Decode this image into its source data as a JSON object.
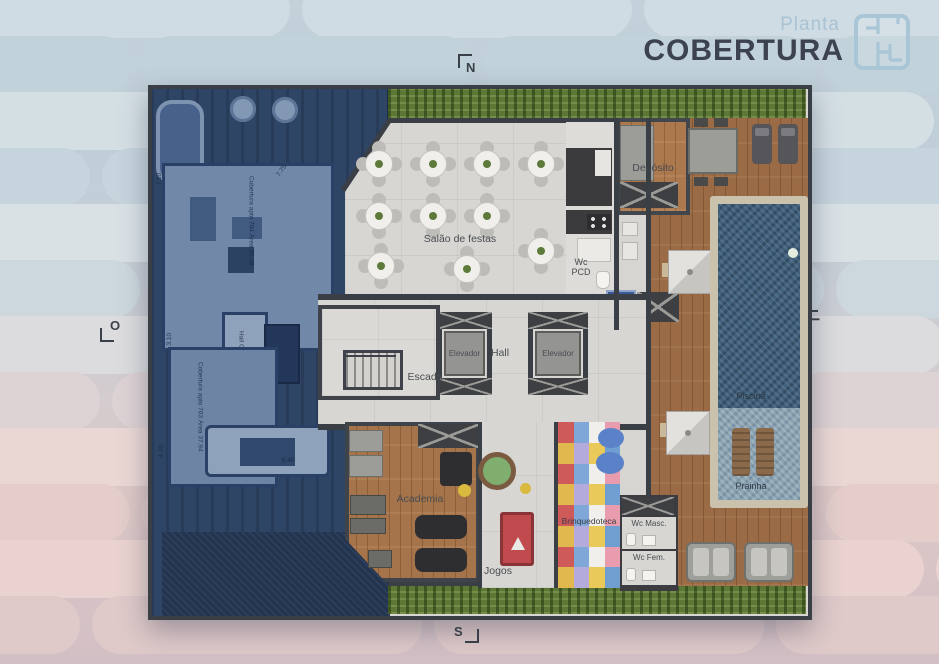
{
  "header": {
    "subtitle": "Planta",
    "title": "COBERTURA"
  },
  "compass": {
    "north": "N",
    "south": "S",
    "west": "O",
    "east": "L"
  },
  "labels": {
    "deposito": "Depósito",
    "salao_de_festas": "Salão de festas",
    "wc_pcd": "Wc PCD",
    "elevador_left": "Elevador",
    "elevador_right": "Elevador",
    "hall": "Hall",
    "escada": "Escada",
    "academia": "Academia",
    "jogos": "Jogos",
    "brinquedoteca": "Brinquedoteca",
    "wc_masc": "Wc Masc.",
    "wc_fem": "Wc Fem.",
    "piscina": "Piscina",
    "prainha": "Prainha"
  },
  "dimmed_units": {
    "apto_704": "Cobertura apto 704 Área 55.38",
    "hall_cobertura": "Hall Cobertura",
    "apto_703": "Cobertura apto 703 Área 37.94",
    "dim_7_10": "7.10",
    "dim_7_75": "7.75",
    "dim_3_10": "3.10",
    "dim_4_70": "4.70",
    "dim_6_40": "6.40"
  },
  "icons": {
    "accessibility_sign": "♿"
  },
  "colors": {
    "title": "#3c434e",
    "subtitle_accent": "#a9c3d4",
    "label_text": "#494c52",
    "floor": "#d6d5d1",
    "wood_deck": "#9a6b45",
    "hedge_green": "#5d7836",
    "pool_water": "#40607b",
    "prainha_shallow": "#8ba3b2",
    "pool_table_red": "#c04a4e",
    "dimmed_units_blue": "#2f4566",
    "accessibility_sign_blue": "#3b5a9c",
    "background_top": "#c9d6de",
    "background_bottom": "#e6cfcc"
  }
}
